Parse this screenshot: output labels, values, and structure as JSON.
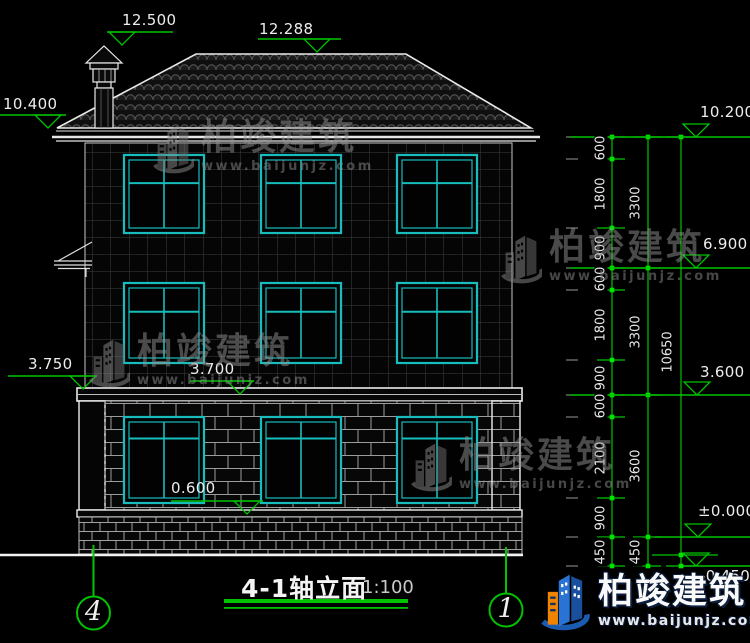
{
  "drawing": {
    "title": "4-1轴立面",
    "scale": "1:100",
    "axis_labels": [
      "4",
      "1"
    ],
    "elevations": [
      "12.500",
      "12.288",
      "10.400",
      "10.200",
      "6.900",
      "3.600",
      "±0.000",
      "-0.450",
      "3.750",
      "3.700",
      "0.600"
    ],
    "dim_col1": [
      "600",
      "1800",
      "900",
      "600",
      "1800",
      "900",
      "600",
      "2100",
      "900",
      "450"
    ],
    "dim_col2": [
      "3300",
      "3300",
      "3600",
      "450"
    ],
    "dim_col3": [
      "10650"
    ]
  },
  "watermark": {
    "name": "柏竣建筑",
    "url": "www.baijunjz.com"
  },
  "brand": {
    "name": "柏竣建筑",
    "url": "www.baijunjz.com"
  },
  "colors": {
    "dimension_green": "#00c400",
    "dot_green": "#00e400",
    "window_cyan": "#17bdbd",
    "line_white": "#ededed",
    "brand_blue": "#1c5cb0",
    "brand_orange": "#f08300"
  }
}
